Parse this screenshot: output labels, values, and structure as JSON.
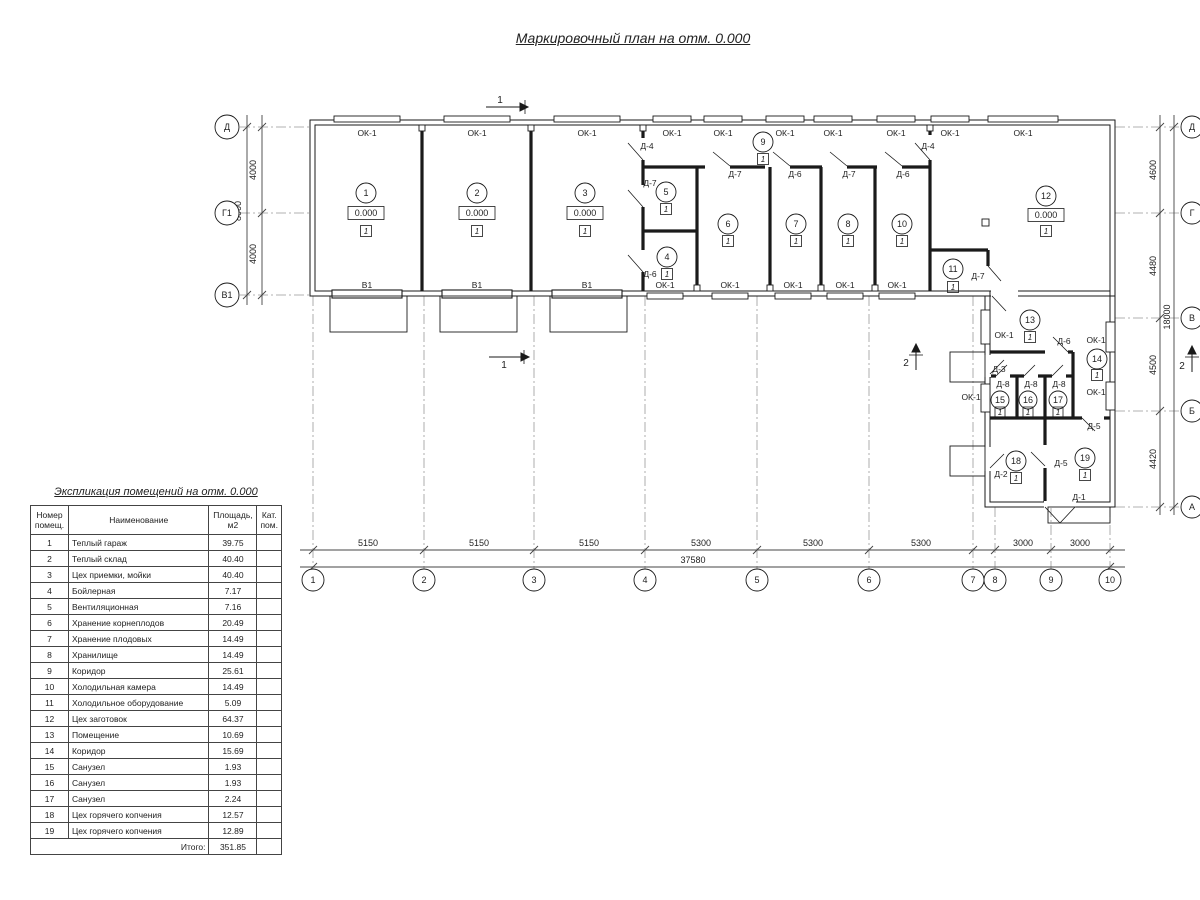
{
  "title": "Маркировочный план на отм. 0.000",
  "explication": {
    "title": "Экспликация помещений на отм. 0.000",
    "headers": [
      "Номер помещ.",
      "Наименование",
      "Площадь, м2",
      "Кат. пом."
    ],
    "rows": [
      [
        "1",
        "Теплый гараж",
        "39.75",
        ""
      ],
      [
        "2",
        "Теплый склад",
        "40.40",
        ""
      ],
      [
        "3",
        "Цех приемки, мойки",
        "40.40",
        ""
      ],
      [
        "4",
        "Бойлерная",
        "7.17",
        ""
      ],
      [
        "5",
        "Вентиляционная",
        "7.16",
        ""
      ],
      [
        "6",
        "Хранение корнеплодов",
        "20.49",
        ""
      ],
      [
        "7",
        "Хранение плодовых",
        "14.49",
        ""
      ],
      [
        "8",
        "Хранилище",
        "14.49",
        ""
      ],
      [
        "9",
        "Коридор",
        "25.61",
        ""
      ],
      [
        "10",
        "Холодильная камера",
        "14.49",
        ""
      ],
      [
        "11",
        "Холодильное оборудование",
        "5.09",
        ""
      ],
      [
        "12",
        "Цех заготовок",
        "64.37",
        ""
      ],
      [
        "13",
        "Помещение",
        "10.69",
        ""
      ],
      [
        "14",
        "Коридор",
        "15.69",
        ""
      ],
      [
        "15",
        "Санузел",
        "1.93",
        ""
      ],
      [
        "16",
        "Санузел",
        "1.93",
        ""
      ],
      [
        "17",
        "Санузел",
        "2.24",
        ""
      ],
      [
        "18",
        "Цех горячего копчения",
        "12.57",
        ""
      ],
      [
        "19",
        "Цех горячего копчения",
        "12.89",
        ""
      ]
    ],
    "total_label": "Итого:",
    "total_value": "351.85"
  },
  "plan": {
    "window_label": "ОК-1",
    "gate_label": "В1",
    "elevation_mark": "0.000",
    "floor_mark": "1",
    "doors": {
      "d1": "Д-1",
      "d2": "Д-2",
      "d3": "Д-3",
      "d4": "Д-4",
      "d5": "Д-5",
      "d6": "Д-6",
      "d7": "Д-7",
      "d8": "Д-8"
    },
    "rooms": {
      "r1": "1",
      "r2": "2",
      "r3": "3",
      "r4": "4",
      "r5": "5",
      "r6": "6",
      "r7": "7",
      "r8": "8",
      "r9": "9",
      "r10": "10",
      "r11": "11",
      "r12": "12",
      "r13": "13",
      "r14": "14",
      "r15": "15",
      "r16": "16",
      "r17": "17",
      "r18": "18",
      "r19": "19"
    },
    "axes": {
      "left": [
        "Д",
        "Г1",
        "В1"
      ],
      "right": [
        "Д",
        "Г",
        "В",
        "Б",
        "А"
      ],
      "bottom": [
        "1",
        "2",
        "3",
        "4",
        "5",
        "6",
        "7",
        "8",
        "9",
        "10"
      ]
    },
    "dims": {
      "bottom": [
        "5150",
        "5150",
        "5150",
        "5300",
        "5300",
        "5300",
        "3000",
        "3000"
      ],
      "bottom_total": "37580",
      "left": [
        "4000",
        "4000"
      ],
      "left_total": "8000",
      "right": [
        "4600",
        "4480",
        "4500",
        "4420"
      ],
      "right_total": "18000"
    },
    "sections": {
      "s1": "1",
      "s2": "2"
    }
  }
}
